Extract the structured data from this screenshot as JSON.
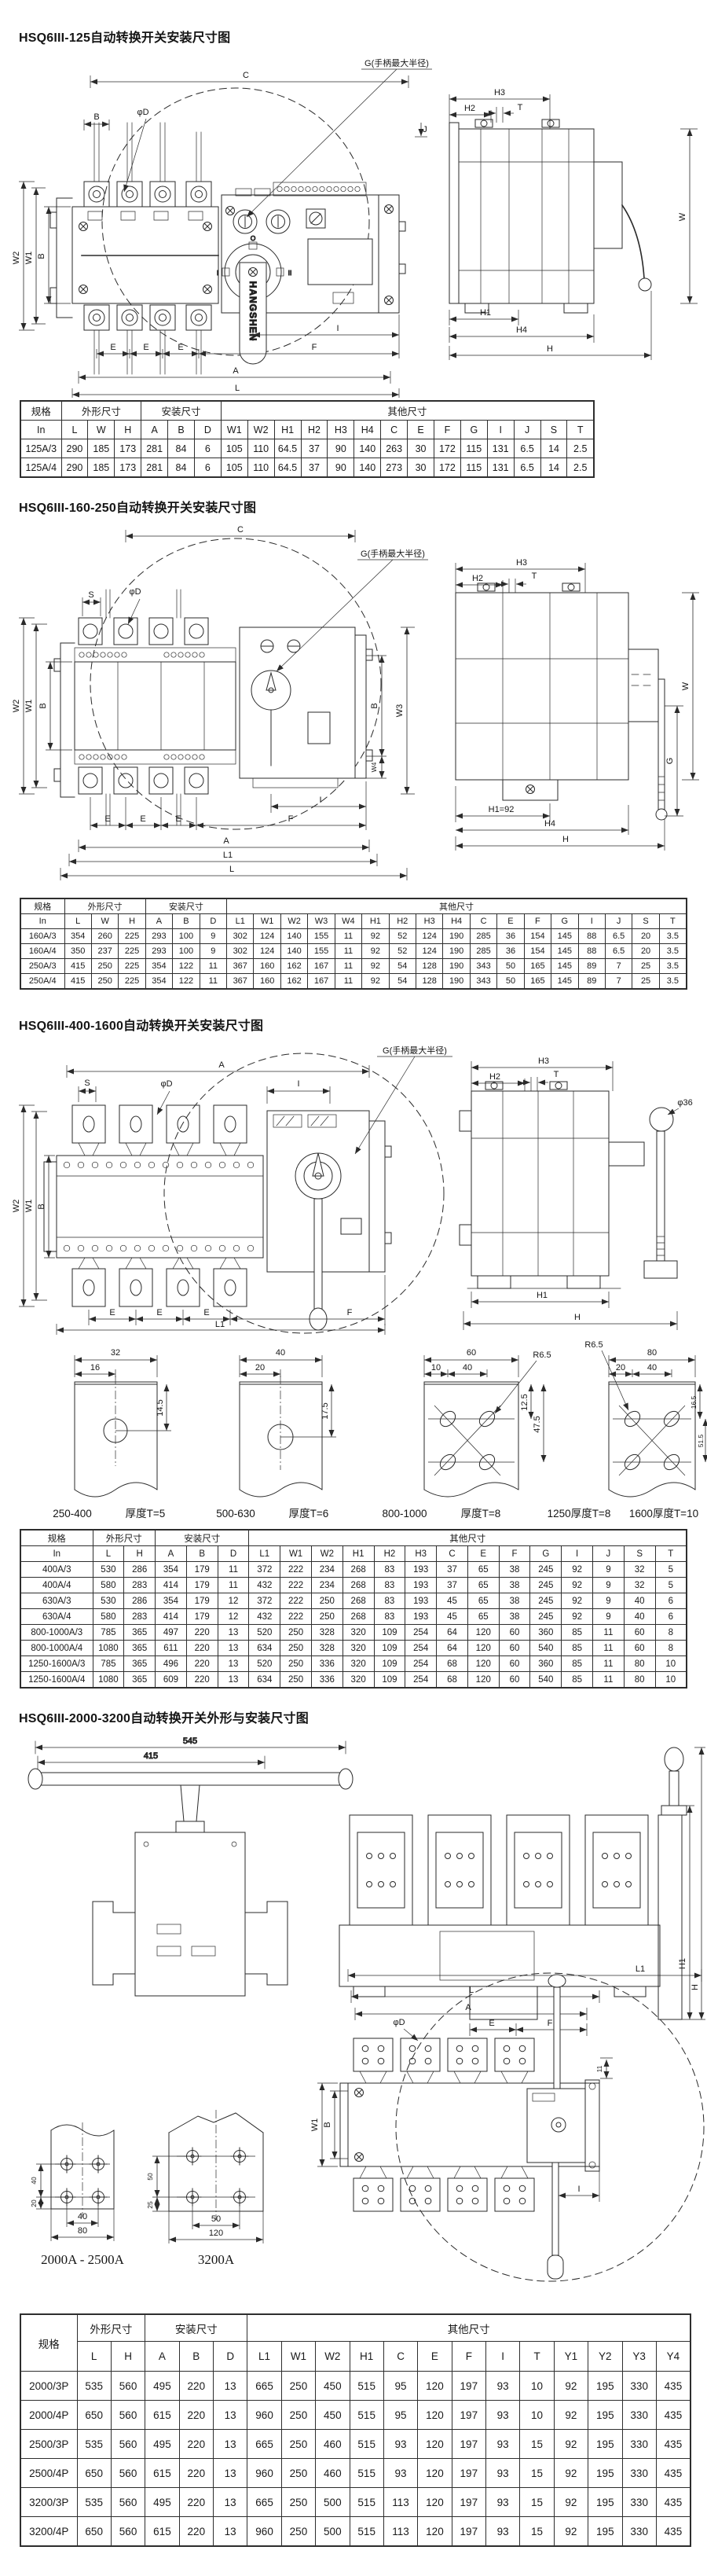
{
  "sections": [
    {
      "title": "HSQ6III-125自动转换开关安装尺寸图"
    },
    {
      "title": "HSQ6III-160-250自动转换开关安装尺寸图"
    },
    {
      "title": "HSQ6III-400-1600自动转换开关安装尺寸图"
    },
    {
      "title": "HSQ6III-2000-3200自动转换开关外形与安装尺寸图"
    }
  ],
  "dims": {
    "C": "C",
    "B": "B",
    "phiD": "φD",
    "S": "S",
    "W": "W",
    "W1": "W1",
    "W2": "W2",
    "W3": "W3",
    "W4": "W4",
    "H": "H",
    "H1": "H1",
    "H2": "H2",
    "H3": "H3",
    "H4": "H4",
    "T": "T",
    "E": "E",
    "F": "F",
    "G": "G",
    "A": "A",
    "L": "L",
    "L1": "L1",
    "I": "I",
    "J": "J",
    "g_note": "G(手柄最大半径)",
    "h1_92": "H1=92",
    "phi36": "φ36",
    "d11": "11",
    "brand": "HANGSHEN",
    "knob_o": "O",
    "knob_i": "I",
    "knob_ii": "II"
  },
  "tables": [
    {
      "corner": "规格",
      "corner_sub": "In",
      "groups": [
        {
          "label": "外形尺寸",
          "span": 3
        },
        {
          "label": "安装尺寸",
          "span": 3
        },
        {
          "label": "其他尺寸",
          "span": 14
        }
      ],
      "columns": [
        "L",
        "W",
        "H",
        "A",
        "B",
        "D",
        "W1",
        "W2",
        "H1",
        "H2",
        "H3",
        "H4",
        "C",
        "E",
        "F",
        "G",
        "I",
        "J",
        "S",
        "T"
      ],
      "rows": [
        [
          "125A/3",
          "290",
          "185",
          "173",
          "281",
          "84",
          "6",
          "105",
          "110",
          "64.5",
          "37",
          "90",
          "140",
          "263",
          "30",
          "172",
          "115",
          "131",
          "6.5",
          "14",
          "2.5"
        ],
        [
          "125A/4",
          "290",
          "185",
          "173",
          "281",
          "84",
          "6",
          "105",
          "110",
          "64.5",
          "37",
          "90",
          "140",
          "273",
          "30",
          "172",
          "115",
          "131",
          "6.5",
          "14",
          "2.5"
        ]
      ]
    },
    {
      "corner": "规格",
      "corner_sub": "In",
      "groups": [
        {
          "label": "外形尺寸",
          "span": 3
        },
        {
          "label": "安装尺寸",
          "span": 3
        },
        {
          "label": "其他尺寸",
          "span": 17
        }
      ],
      "columns": [
        "L",
        "W",
        "H",
        "A",
        "B",
        "D",
        "L1",
        "W1",
        "W2",
        "W3",
        "W4",
        "H1",
        "H2",
        "H3",
        "H4",
        "C",
        "E",
        "F",
        "G",
        "I",
        "J",
        "S",
        "T"
      ],
      "rows": [
        [
          "160A/3",
          "354",
          "260",
          "225",
          "293",
          "100",
          "9",
          "302",
          "124",
          "140",
          "155",
          "11",
          "92",
          "52",
          "124",
          "190",
          "285",
          "36",
          "154",
          "145",
          "88",
          "6.5",
          "20",
          "3.5"
        ],
        [
          "160A/4",
          "350",
          "237",
          "225",
          "293",
          "100",
          "9",
          "302",
          "124",
          "140",
          "155",
          "11",
          "92",
          "52",
          "124",
          "190",
          "285",
          "36",
          "154",
          "145",
          "88",
          "6.5",
          "20",
          "3.5"
        ],
        [
          "250A/3",
          "415",
          "250",
          "225",
          "354",
          "122",
          "11",
          "367",
          "160",
          "162",
          "167",
          "11",
          "92",
          "54",
          "128",
          "190",
          "343",
          "50",
          "165",
          "145",
          "89",
          "7",
          "25",
          "3.5"
        ],
        [
          "250A/4",
          "415",
          "250",
          "225",
          "354",
          "122",
          "11",
          "367",
          "160",
          "162",
          "167",
          "11",
          "92",
          "54",
          "128",
          "190",
          "343",
          "50",
          "165",
          "145",
          "89",
          "7",
          "25",
          "3.5"
        ]
      ]
    },
    {
      "corner": "规格",
      "corner_sub": "In",
      "groups": [
        {
          "label": "外形尺寸",
          "span": 2
        },
        {
          "label": "安装尺寸",
          "span": 3
        },
        {
          "label": "其他尺寸",
          "span": 14
        }
      ],
      "columns": [
        "L",
        "H",
        "A",
        "B",
        "D",
        "L1",
        "W1",
        "W2",
        "H1",
        "H2",
        "H3",
        "C",
        "E",
        "F",
        "G",
        "I",
        "J",
        "S",
        "T"
      ],
      "rows": [
        [
          "400A/3",
          "530",
          "286",
          "354",
          "179",
          "11",
          "372",
          "222",
          "234",
          "268",
          "83",
          "193",
          "37",
          "65",
          "38",
          "245",
          "92",
          "9",
          "32",
          "5"
        ],
        [
          "400A/4",
          "580",
          "283",
          "414",
          "179",
          "11",
          "432",
          "222",
          "234",
          "268",
          "83",
          "193",
          "37",
          "65",
          "38",
          "245",
          "92",
          "9",
          "32",
          "5"
        ],
        [
          "630A/3",
          "530",
          "286",
          "354",
          "179",
          "12",
          "372",
          "222",
          "250",
          "268",
          "83",
          "193",
          "45",
          "65",
          "38",
          "245",
          "92",
          "9",
          "40",
          "6"
        ],
        [
          "630A/4",
          "580",
          "283",
          "414",
          "179",
          "12",
          "432",
          "222",
          "250",
          "268",
          "83",
          "193",
          "45",
          "65",
          "38",
          "245",
          "92",
          "9",
          "40",
          "6"
        ],
        [
          "800-1000A/3",
          "785",
          "365",
          "497",
          "220",
          "13",
          "520",
          "250",
          "328",
          "320",
          "109",
          "254",
          "64",
          "120",
          "60",
          "360",
          "85",
          "11",
          "60",
          "8"
        ],
        [
          "800-1000A/4",
          "1080",
          "365",
          "611",
          "220",
          "13",
          "634",
          "250",
          "328",
          "320",
          "109",
          "254",
          "64",
          "120",
          "60",
          "540",
          "85",
          "11",
          "60",
          "8"
        ],
        [
          "1250-1600A/3",
          "785",
          "365",
          "496",
          "220",
          "13",
          "520",
          "250",
          "336",
          "320",
          "109",
          "254",
          "68",
          "120",
          "60",
          "360",
          "85",
          "11",
          "80",
          "10"
        ],
        [
          "1250-1600A/4",
          "1080",
          "365",
          "609",
          "220",
          "13",
          "634",
          "250",
          "336",
          "320",
          "109",
          "254",
          "68",
          "120",
          "60",
          "540",
          "85",
          "11",
          "80",
          "10"
        ]
      ]
    },
    {
      "corner": "规格",
      "corner_sub": null,
      "groups": [
        {
          "label": "外形尺寸",
          "span": 2
        },
        {
          "label": "安装尺寸",
          "span": 3
        },
        {
          "label": "其他尺寸",
          "span": 13
        }
      ],
      "columns": [
        "L",
        "H",
        "A",
        "B",
        "D",
        "L1",
        "W1",
        "W2",
        "H1",
        "C",
        "E",
        "F",
        "I",
        "T",
        "Y1",
        "Y2",
        "Y3",
        "Y4"
      ],
      "rows": [
        [
          "2000/3P",
          "535",
          "560",
          "495",
          "220",
          "13",
          "665",
          "250",
          "450",
          "515",
          "95",
          "120",
          "197",
          "93",
          "10",
          "92",
          "195",
          "330",
          "435"
        ],
        [
          "2000/4P",
          "650",
          "560",
          "615",
          "220",
          "13",
          "960",
          "250",
          "450",
          "515",
          "95",
          "120",
          "197",
          "93",
          "10",
          "92",
          "195",
          "330",
          "435"
        ],
        [
          "2500/3P",
          "535",
          "560",
          "495",
          "220",
          "13",
          "665",
          "250",
          "460",
          "515",
          "93",
          "120",
          "197",
          "93",
          "15",
          "92",
          "195",
          "330",
          "435"
        ],
        [
          "2500/4P",
          "650",
          "560",
          "615",
          "220",
          "13",
          "960",
          "250",
          "460",
          "515",
          "93",
          "120",
          "197",
          "93",
          "15",
          "92",
          "195",
          "330",
          "435"
        ],
        [
          "3200/3P",
          "535",
          "560",
          "495",
          "220",
          "13",
          "665",
          "250",
          "500",
          "515",
          "113",
          "120",
          "197",
          "93",
          "15",
          "92",
          "195",
          "330",
          "435"
        ],
        [
          "3200/4P",
          "650",
          "560",
          "615",
          "220",
          "13",
          "960",
          "250",
          "500",
          "515",
          "113",
          "120",
          "197",
          "93",
          "15",
          "92",
          "195",
          "330",
          "435"
        ]
      ]
    }
  ],
  "hole_panels": [
    {
      "dim_top": "32",
      "dim_sub": "16",
      "dim_v": "14.5",
      "cap1": "250-400",
      "cap2": "厚度T=5"
    },
    {
      "dim_top": "40",
      "dim_sub": "20",
      "dim_v": "17.5",
      "cap1": "500-630",
      "cap2": "厚度T=6"
    },
    {
      "dim_top": "60",
      "dim_sub": "10",
      "dim_sub2": "40",
      "radius": "R6.5",
      "dim_v": "12.5",
      "dim_v2": "47.5",
      "cap1": "800-1000",
      "cap2": "厚度T=8"
    },
    {
      "dim_top": "80",
      "dim_sub": "20",
      "dim_sub2": "40",
      "radius": "R6.5",
      "dim_v": "16.5",
      "dim_v2": "51.5",
      "cap1": "1250厚度T=8",
      "cap2": "1600厚度T=10"
    }
  ],
  "s4": {
    "handle": {
      "d1": "545",
      "d2": "415"
    },
    "details": [
      {
        "dv1": "40",
        "dv2": "20",
        "db1": "40",
        "db2": "80",
        "caption": "2000A - 2500A"
      },
      {
        "dv1": "50",
        "dv2": "25",
        "db1": "50",
        "db2": "120",
        "caption": "3200A"
      }
    ]
  }
}
